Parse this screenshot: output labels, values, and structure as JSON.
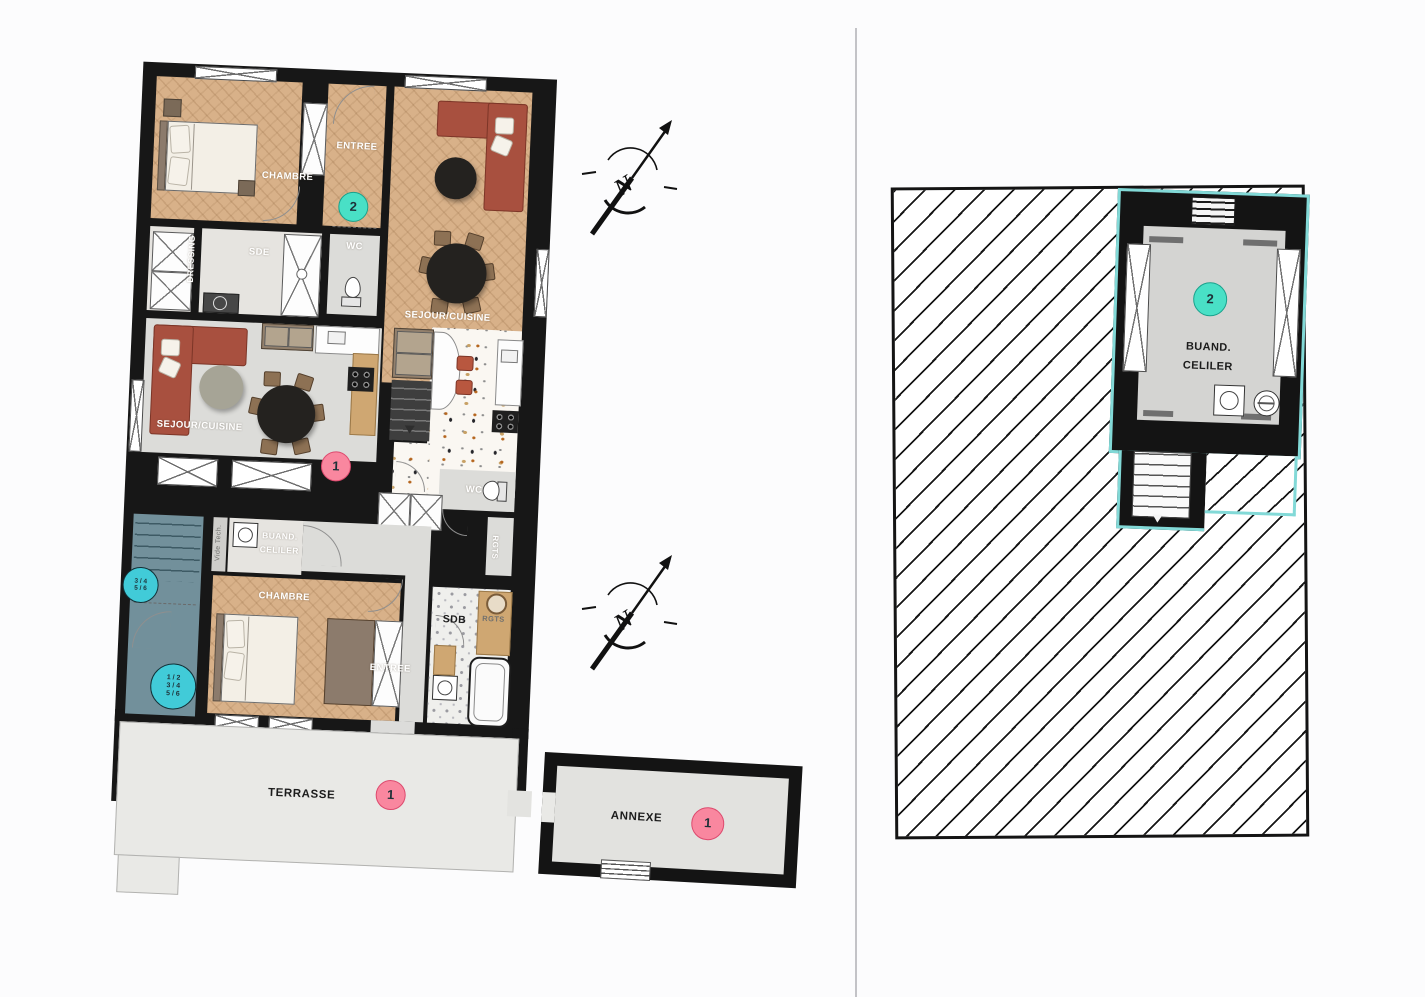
{
  "colors": {
    "wall": "#171717",
    "wood_floor": "#d8b189",
    "grey_floor": "#dcdcd9",
    "slate_stairwell": "#72909b",
    "terrace": "#e9e9e6",
    "badge_pink": "#f9879f",
    "badge_pink_border": "#dd4a6e",
    "badge_teal": "#49e0c6",
    "badge_teal_border": "#1aa18c",
    "stair_badge_cyan": "#41cbd8",
    "unit_outline_teal": "#82d9d7"
  },
  "apartment2": {
    "badge": "2",
    "chambre": "CHAMBRE",
    "entree": "ENTREE",
    "dressing": "DRESSING",
    "sde": "SDE",
    "wc_top": "WC",
    "sejour": "SEJOUR/CUISINE",
    "wc_mid": "WC",
    "rgts": "RGTS"
  },
  "apartment1": {
    "badge": "1",
    "sejour": "SEJOUR/CUISINE",
    "buand_line1": "BUAND.",
    "buand_line2": "CELILER",
    "vide_tech": "Vide Tech.",
    "chambre": "CHAMBRE",
    "entree": "ENTREE",
    "sdb": "SDB",
    "rgts": "RGTS"
  },
  "stairwell": {
    "badge_upper": {
      "line1": "3 / 4",
      "line2": "5 / 6"
    },
    "badge_lower": {
      "line1": "1 / 2",
      "line2": "3 / 4",
      "line3": "5 / 6"
    }
  },
  "outdoor": {
    "terrasse_label": "TERRASSE",
    "terrasse_badge": "1",
    "annexe_label": "ANNEXE",
    "annexe_badge": "1"
  },
  "detail_plan": {
    "badge": "2",
    "room_line1": "BUAND.",
    "room_line2": "CELILER"
  },
  "compass": {
    "north": "N"
  }
}
